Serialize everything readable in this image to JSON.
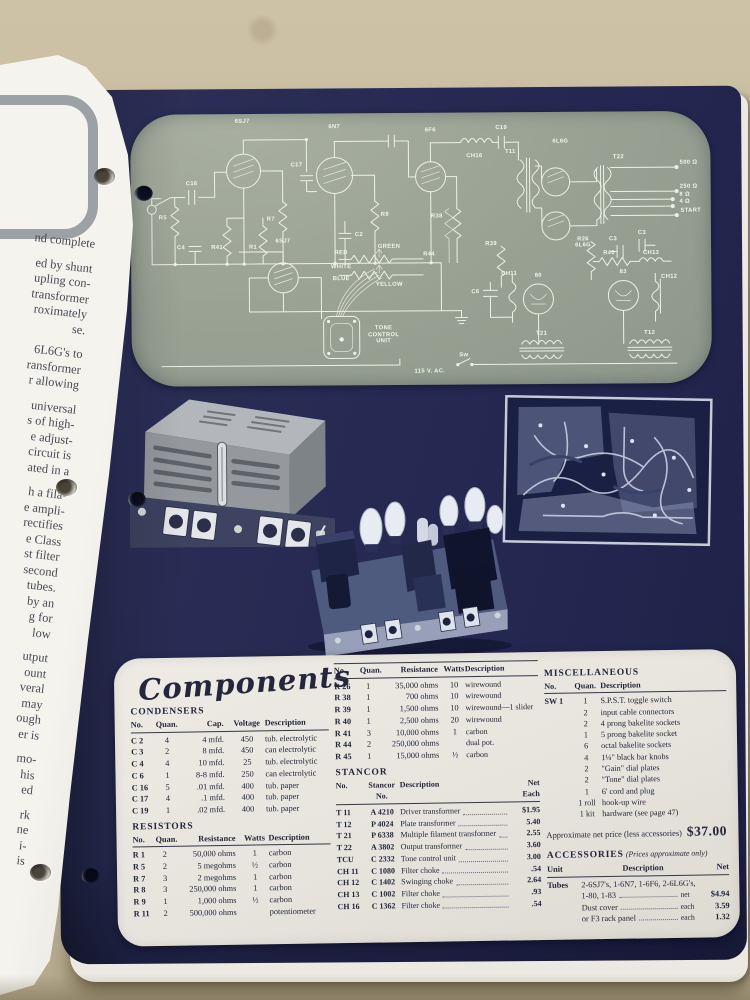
{
  "left_page": {
    "lines": [
      "nd complete",
      "",
      "ed by shunt",
      "upling con-",
      "transformer",
      "roximately",
      "se.",
      "",
      "6L6G's to",
      "ransformer",
      "r allowing",
      "",
      "universal",
      "s of high-",
      "e adjust-",
      "circuit is",
      "ated in a",
      "",
      "h a fila-",
      "e ampli-",
      "rectifies",
      "e Class",
      "st filter",
      "second",
      "tubes.",
      "by an",
      "g for",
      "low",
      "",
      "utput",
      "ount",
      "veral",
      "may",
      "ough",
      "er is",
      "",
      "mo-",
      "his",
      "ed",
      "",
      "rk",
      "ne",
      "i-",
      "is"
    ]
  },
  "schematic": {
    "panel_color": "#9aa294",
    "line_color": "#edf0e4",
    "labels": [
      {
        "t": "6SJ7",
        "x": 112,
        "y": 8
      },
      {
        "t": "6N7",
        "x": 204,
        "y": 14
      },
      {
        "t": "6F6",
        "x": 300,
        "y": 18
      },
      {
        "t": "6L6G",
        "x": 430,
        "y": 30
      },
      {
        "t": "6SJ7",
        "x": 152,
        "y": 128
      },
      {
        "t": "6L6G",
        "x": 452,
        "y": 134
      },
      {
        "t": "80",
        "x": 407,
        "y": 164
      },
      {
        "t": "83",
        "x": 492,
        "y": 161
      },
      {
        "t": "T11",
        "x": 380,
        "y": 40
      },
      {
        "t": "T22",
        "x": 488,
        "y": 46
      },
      {
        "t": "T21",
        "x": 410,
        "y": 222
      },
      {
        "t": "T12",
        "x": 518,
        "y": 222
      },
      {
        "t": "CH16",
        "x": 344,
        "y": 44
      },
      {
        "t": "C19",
        "x": 371,
        "y": 16
      },
      {
        "t": "CH11",
        "x": 378,
        "y": 162
      },
      {
        "t": "CH12",
        "x": 538,
        "y": 166
      },
      {
        "t": "CH13",
        "x": 520,
        "y": 142
      },
      {
        "t": "R38",
        "x": 306,
        "y": 104
      },
      {
        "t": "R39",
        "x": 360,
        "y": 132
      },
      {
        "t": "R26",
        "x": 452,
        "y": 128
      },
      {
        "t": "R40",
        "x": 478,
        "y": 142
      },
      {
        "t": "C6",
        "x": 344,
        "y": 180
      },
      {
        "t": "C3",
        "x": 482,
        "y": 128
      },
      {
        "t": "C3",
        "x": 511,
        "y": 122
      },
      {
        "t": "C16",
        "x": 61,
        "y": 70
      },
      {
        "t": "R5",
        "x": 32,
        "y": 104
      },
      {
        "t": "C17",
        "x": 166,
        "y": 52
      },
      {
        "t": "R7",
        "x": 140,
        "y": 106
      },
      {
        "t": "R1",
        "x": 122,
        "y": 134
      },
      {
        "t": "R41",
        "x": 86,
        "y": 134
      },
      {
        "t": "C4",
        "x": 50,
        "y": 134
      },
      {
        "t": "R8",
        "x": 254,
        "y": 102
      },
      {
        "t": "C2",
        "x": 228,
        "y": 122
      },
      {
        "t": "R44",
        "x": 298,
        "y": 142
      },
      {
        "t": "GREEN",
        "x": 258,
        "y": 134
      },
      {
        "t": "RED",
        "x": 210,
        "y": 140
      },
      {
        "t": "WHITE",
        "x": 210,
        "y": 154
      },
      {
        "t": "BLUE",
        "x": 210,
        "y": 166
      },
      {
        "t": "YELLOW",
        "x": 258,
        "y": 172
      },
      {
        "t": "TONE\nCONTROL\nUNIT",
        "x": 252,
        "y": 222
      },
      {
        "t": "115 V. AC.",
        "x": 298,
        "y": 259
      },
      {
        "t": "Sw",
        "x": 332,
        "y": 243
      },
      {
        "t": "500 Ω",
        "x": 558,
        "y": 52
      },
      {
        "t": "250 Ω",
        "x": 558,
        "y": 76
      },
      {
        "t": "8 Ω",
        "x": 554,
        "y": 84
      },
      {
        "t": "4 Ω",
        "x": 554,
        "y": 91
      },
      {
        "t": "START",
        "x": 560,
        "y": 100
      }
    ]
  },
  "components": {
    "title": "Components",
    "condensers": {
      "title": "CONDENSERS",
      "headers": [
        "No.",
        "Quan.",
        "Cap.",
        "Voltage",
        "Description"
      ],
      "rows": [
        [
          "C 2",
          "4",
          "4 mfd.",
          "450",
          "tub. electrolytic"
        ],
        [
          "C 3",
          "2",
          "8 mfd.",
          "450",
          "can electrolytic"
        ],
        [
          "C 4",
          "4",
          "10 mfd.",
          "25",
          "tub. electrolytic"
        ],
        [
          "C 6",
          "1",
          "8-8 mfd.",
          "250",
          "can electrolytic"
        ],
        [
          "C 16",
          "5",
          ".01 mfd.",
          "400",
          "tub. paper"
        ],
        [
          "C 17",
          "4",
          ".1 mfd.",
          "400",
          "tub. paper"
        ],
        [
          "C 19",
          "1",
          ".02 mfd.",
          "400",
          "tub. paper"
        ]
      ]
    },
    "resistors": {
      "title": "RESISTORS",
      "headers": [
        "No.",
        "Quan.",
        "Resistance",
        "Watts",
        "Description"
      ],
      "rows": [
        [
          "R 1",
          "2",
          "50,000 ohms",
          "1",
          "carbon"
        ],
        [
          "R 5",
          "2",
          "5 megohms",
          "½",
          "carbon"
        ],
        [
          "R 7",
          "3",
          "2 megohms",
          "1",
          "carbon"
        ],
        [
          "R 8",
          "3",
          "250,000 ohms",
          "1",
          "carbon"
        ],
        [
          "R 9",
          "1",
          "1,000 ohms",
          "½",
          "carbon"
        ],
        [
          "R 11",
          "2",
          "500,000 ohms",
          "",
          "potentiometer"
        ]
      ]
    },
    "resistors2": {
      "headers": [
        "No.",
        "Quan.",
        "Resistance",
        "Watts",
        "Description"
      ],
      "rows": [
        [
          "R 26",
          "1",
          "35,000 ohms",
          "10",
          "wirewound"
        ],
        [
          "R 38",
          "1",
          "700 ohms",
          "10",
          "wirewound"
        ],
        [
          "R 39",
          "1",
          "1,500 ohms",
          "10",
          "wirewound—1 slider"
        ],
        [
          "R 40",
          "1",
          "2,500 ohms",
          "20",
          "wirewound"
        ],
        [
          "R 41",
          "3",
          "10,000 ohms",
          "1",
          "carbon"
        ],
        [
          "R 44",
          "2",
          "250,000 ohms",
          "",
          "dual pot."
        ],
        [
          "R 45",
          "1",
          "15,000 ohms",
          "½",
          "carbon"
        ]
      ]
    },
    "stancor": {
      "title": "STANCOR",
      "headers": [
        "No.",
        "Stancor\nNo.",
        "Description",
        "Net\nEach"
      ],
      "rows": [
        [
          "T 11",
          "A 4210",
          "Driver transformer",
          "$1.95"
        ],
        [
          "T 12",
          "P 4024",
          "Plate transformer",
          "5.40"
        ],
        [
          "T 21",
          "P 6338",
          "Multiple filament transformer",
          "2.55"
        ],
        [
          "T 22",
          "A 3802",
          "Output transformer",
          "3.60"
        ],
        [
          "TCU",
          "C 2332",
          "Tone control unit",
          "3.00"
        ],
        [
          "CH 11",
          "C 1080",
          "Filter choke",
          ".54"
        ],
        [
          "CH 12",
          "C 1402",
          "Swinging choke",
          "2.64"
        ],
        [
          "CH 13",
          "C 1002",
          "Filter choke",
          ".93"
        ],
        [
          "CH 16",
          "C 1362",
          "Filter choke",
          ".54"
        ]
      ]
    },
    "miscellaneous": {
      "title": "MISCELLANEOUS",
      "headers": [
        "No.",
        "Quan.",
        "Description"
      ],
      "rows": [
        [
          "SW 1",
          "1",
          "S.P.S.T. toggle switch"
        ],
        [
          "",
          "2",
          "input cable connectors"
        ],
        [
          "",
          "2",
          "4 prong bakelite sockets"
        ],
        [
          "",
          "1",
          "5 prong bakelite socket"
        ],
        [
          "",
          "6",
          "octal bakelite sockets"
        ],
        [
          "",
          "4",
          "1¼\" black bar knobs"
        ],
        [
          "",
          "2",
          "\"Gain\" dial plates"
        ],
        [
          "",
          "2",
          "\"Tone\" dial plates"
        ],
        [
          "",
          "1",
          "6' cord and plug"
        ],
        [
          "",
          "1 roll",
          "hook-up wire"
        ],
        [
          "",
          "1 kit",
          "hardware (see page 47)"
        ]
      ]
    },
    "price_note": "Approximate net price (less accessories)",
    "price": "$37.00",
    "accessories": {
      "title": "ACCESSORIES",
      "note": "(Prices approximate only)",
      "headers": [
        "Unit",
        "Description",
        "Net"
      ],
      "rows": [
        {
          "unit": "Tubes",
          "desc": "2-6SJ7's, 1-6N7, 1-6F6, 2-6L6G's,",
          "desc2": "1-80, 1-83",
          "qual": "net",
          "net": "$4.94"
        },
        {
          "unit": "",
          "desc": "Dust cover",
          "desc2": "",
          "qual": "each",
          "net": "3.59"
        },
        {
          "unit": "",
          "desc": "or F3 rack panel",
          "desc2": "",
          "qual": "each",
          "net": "1.32"
        }
      ]
    }
  }
}
